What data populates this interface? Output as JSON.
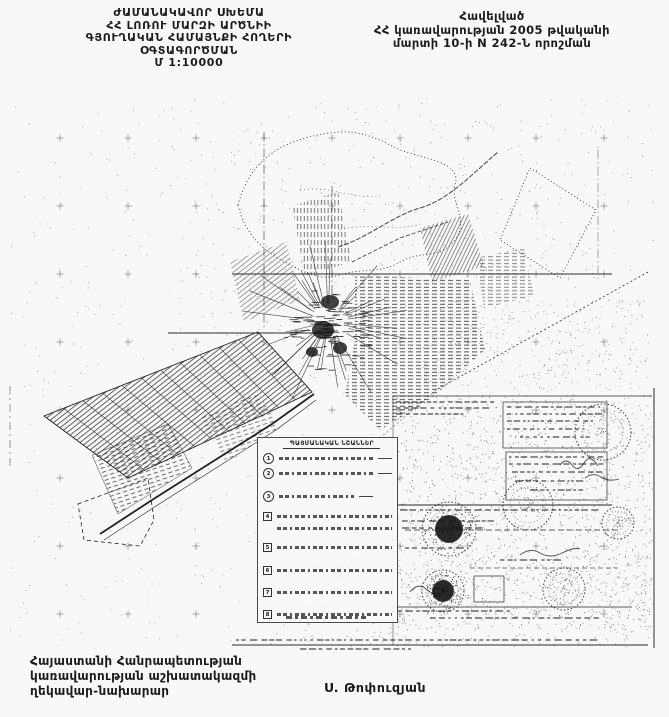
{
  "page": {
    "background": "#f8f8f8",
    "ink": "#1b1b1b",
    "scale_label": "Մ 1:10000"
  },
  "header": {
    "title_lines": [
      "ԺԱՄԱՆԱԿԱՎՈՐ ՍԽԵՄԱ",
      "ՀՀ ԼՈՌՈՒ ՄԱՐԶԻ ԱՐԾՆԻԻ",
      "ԳՅՈՒՂԱԿԱՆ ՀԱՄԱՅՆՔԻ ՀՈՂԵՐԻ",
      "ՕԳՏԱԳՈՐԾՄԱՆ",
      "Մ 1:10000"
    ],
    "approval_lines": [
      "Հավելված",
      "ՀՀ կառավարության 2005 թվականի",
      "մարտի 10-ի N 242-Ն որոշման"
    ]
  },
  "map": {
    "legend": {
      "title": "ՊԱՅՄԱՆԱԿԱՆ ՆՇԱՆՆԵՐ",
      "items": [
        {
          "num": "1"
        },
        {
          "num": "2"
        },
        {
          "num": "3"
        },
        {
          "num": "4"
        },
        {
          "num": "5"
        },
        {
          "num": "6"
        },
        {
          "num": "7"
        },
        {
          "num": "8"
        }
      ]
    }
  },
  "footer": {
    "office_lines": [
      "Հայաստանի Հանրապետության",
      "կառավարության աշխատակազմի",
      "ղեկավար-նախարար"
    ],
    "signature": "Ս. Թոփուզյան"
  }
}
